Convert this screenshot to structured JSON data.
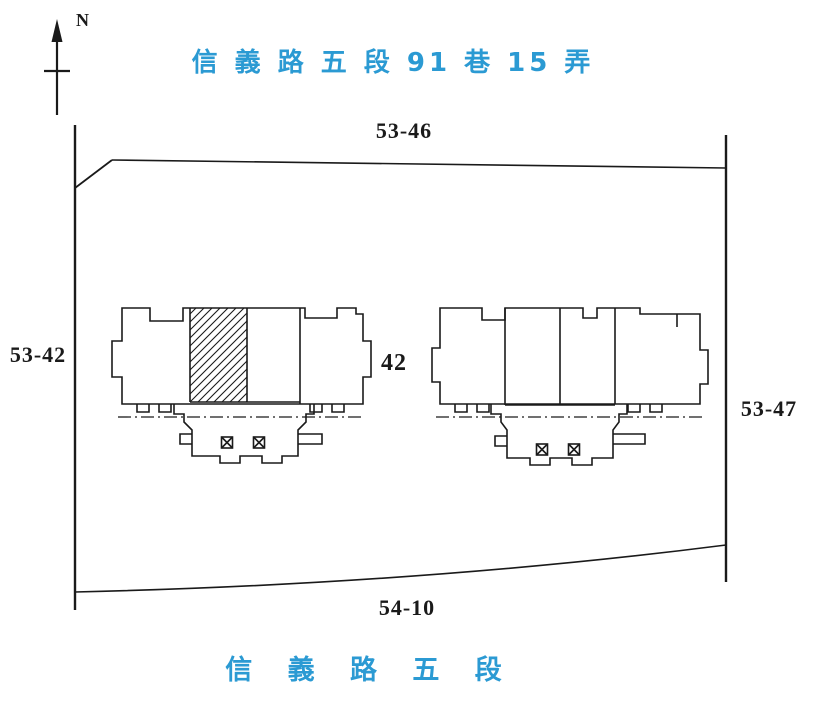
{
  "colors": {
    "background": "#ffffff",
    "line": "#1a1a1a",
    "accent_blue": "#2b9ad3"
  },
  "compass": {
    "label": "N"
  },
  "streets": {
    "top_label": "信 義 路 五 段 91 巷 15 弄",
    "bottom_label": "信 義 路 五 段"
  },
  "parcels": {
    "north": "53-46",
    "west": "53-42",
    "east": "53-47",
    "south": "54-10"
  },
  "buildings": {
    "left": {
      "number_label": "42",
      "hatched_unit": true,
      "elevator_symbols": [
        "box-x",
        "box-x"
      ]
    },
    "right": {
      "hatched_unit": false,
      "elevator_symbols": [
        "box-x",
        "box-x"
      ]
    }
  }
}
